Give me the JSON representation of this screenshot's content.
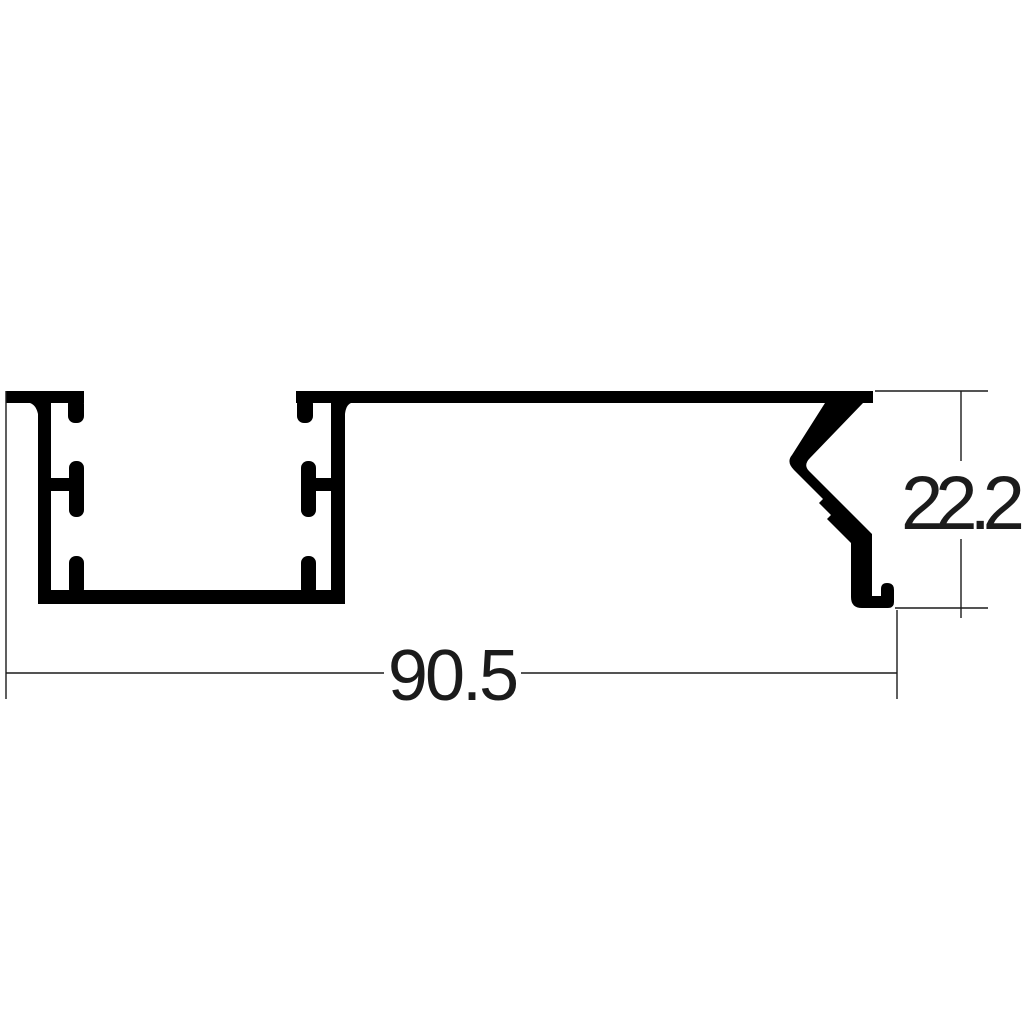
{
  "drawing": {
    "type": "aluminium-extrusion-profile-cross-section",
    "dimensions": {
      "width_label": "90.5",
      "height_label": "22.2"
    },
    "colors": {
      "profile_fill": "#000000",
      "dimension_lines": "#1b1b1b",
      "background": "#ffffff"
    }
  }
}
